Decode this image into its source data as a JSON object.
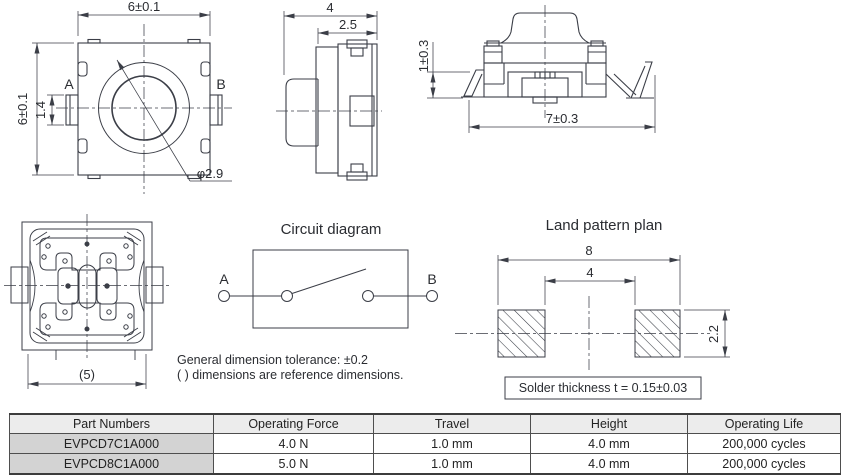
{
  "meta": {
    "background": "#ffffff",
    "line_color": "#3b3e47",
    "text_color": "#2a2c31",
    "table_header_bg": "#ececec",
    "table_part_bg": "#d3d3d3"
  },
  "top_view": {
    "dim_width": "6±0.1",
    "dim_height": "6±0.1",
    "dim_terminal_width": "1.4",
    "dim_button_dia": "φ2.9",
    "label_a": "A",
    "label_b": "B"
  },
  "side_view": {
    "dim_depth": "4",
    "dim_body_depth": "2.5"
  },
  "front_view": {
    "dim_leg_height": "1±0.3",
    "dim_leg_span": "7±0.3"
  },
  "bottom_view": {
    "dim_ref_width": "(5)"
  },
  "circuit_diagram": {
    "title": "Circuit diagram",
    "label_a": "A",
    "label_b": "B"
  },
  "notes": [
    "General dimension tolerance: ±0.2",
    "( ) dimensions are reference dimensions."
  ],
  "land_pattern": {
    "title": "Land pattern plan",
    "dim_outer": "8",
    "dim_gap": "4",
    "dim_pad_height": "2.2",
    "solder_note": "Solder thickness t = 0.15±0.03"
  },
  "table": {
    "headers": [
      "Part Numbers",
      "Operating Force",
      "Travel",
      "Height",
      "Operating Life"
    ],
    "rows": [
      [
        "EVPCD7C1A000",
        "4.0 N",
        "1.0 mm",
        "4.0 mm",
        "200,000 cycles"
      ],
      [
        "EVPCD8C1A000",
        "5.0 N",
        "1.0 mm",
        "4.0 mm",
        "200,000 cycles"
      ]
    ]
  }
}
